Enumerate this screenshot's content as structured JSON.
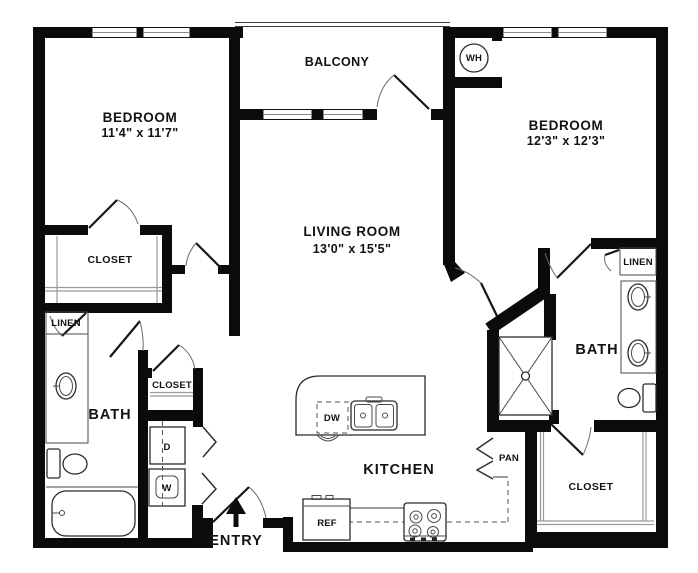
{
  "rooms": {
    "balcony": {
      "label": "BALCONY"
    },
    "bedroom_left": {
      "label": "BEDROOM",
      "dimensions": "11'4\" x 11'7\""
    },
    "bedroom_right": {
      "label": "BEDROOM",
      "dimensions": "12'3\" x 12'3\""
    },
    "living_room": {
      "label": "LIVING ROOM",
      "dimensions": "13'0\" x 15'5\""
    },
    "kitchen": {
      "label": "KITCHEN"
    },
    "bath_left": {
      "label": "BATH"
    },
    "bath_right": {
      "label": "BATH"
    },
    "closet_bedroom_left": {
      "label": "CLOSET"
    },
    "closet_hall": {
      "label": "CLOSET"
    },
    "closet_bedroom_right": {
      "label": "CLOSET"
    },
    "linen_left": {
      "label": "LINEN"
    },
    "linen_right": {
      "label": "LINEN"
    },
    "pantry": {
      "label": "PAN"
    },
    "entry": {
      "label": "ENTRY"
    }
  },
  "appliances": {
    "water_heater": {
      "label": "WH"
    },
    "refrigerator": {
      "label": "REF"
    },
    "dishwasher": {
      "label": "DW"
    },
    "dryer": {
      "label": "D"
    },
    "washer": {
      "label": "W"
    }
  },
  "colors": {
    "wall": "#0b0b0b",
    "text": "#121212",
    "shelf_gray": "#9a9a9a",
    "background": "#ffffff"
  }
}
